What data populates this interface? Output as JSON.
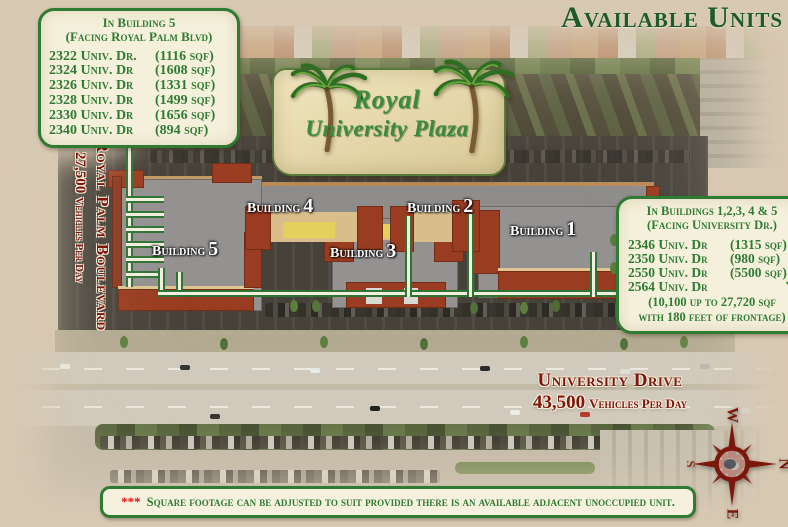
{
  "page_title": "Available Units",
  "logo": {
    "name_line1": "Royal",
    "name_line2": "University Plaza"
  },
  "left_panel": {
    "title_line1": "In Building 5",
    "title_line2": "(Facing Royal Palm Blvd)",
    "units": [
      {
        "address": "2322 Univ. Dr.",
        "size": "(1116 sqf)"
      },
      {
        "address": "2324 Univ. Dr",
        "size": "(1608 sqf)"
      },
      {
        "address": "2326 Univ. Dr",
        "size": "(1331 sqf)"
      },
      {
        "address": "2328 Univ. Dr",
        "size": "(1499 sqf)"
      },
      {
        "address": "2330 Univ. Dr",
        "size": "(1656 sqf)"
      },
      {
        "address": "2340 Univ. Dr",
        "size": "(894 sqf)"
      }
    ]
  },
  "right_panel": {
    "title_line1": "In Buildings 1,2,3, 4 & 5",
    "title_line2": "(Facing University Dr.)",
    "units": [
      {
        "address": "2346 Univ. Dr",
        "size": "(1315 sqf)"
      },
      {
        "address": "2350 Univ. Dr",
        "size": "(980 sqf)"
      },
      {
        "address": "2550 Univ. Dr",
        "size": "(5500 sqf)"
      },
      {
        "address": "2564 Univ. Dr",
        "size": ""
      }
    ],
    "arrow": "↘",
    "note_line1": "(10,100 up to 27,720 sqf",
    "note_line2": "with 180 feet of frontage)"
  },
  "buildings": [
    {
      "word": "Building",
      "number": "4"
    },
    {
      "word": "Building",
      "number": "2"
    },
    {
      "word": "Building",
      "number": "5"
    },
    {
      "word": "Building",
      "number": "3"
    },
    {
      "word": "Building",
      "number": "1"
    }
  ],
  "roads": {
    "royal_palm": {
      "name": "Royal Palm Boulevard",
      "traffic_count": "27,500",
      "traffic_unit": "Vehicles Per Day"
    },
    "university": {
      "name": "University Drive",
      "traffic_count": "43,500",
      "traffic_unit": "Vehicles Per Day"
    }
  },
  "compass": {
    "north": "N",
    "south": "S",
    "east": "E",
    "west": "W"
  },
  "footnote": {
    "stars": "***",
    "text": "Square footage can be adjusted to suit provided there is an available adjacent unoccupied unit."
  },
  "colors": {
    "panel_green": "#2e7b33",
    "title_green": "#1d5c28",
    "road_red": "#7d150b",
    "panel_cream": "#f5f0db",
    "parchment": "#d8c9b3",
    "building_red": "#9a3c21"
  }
}
